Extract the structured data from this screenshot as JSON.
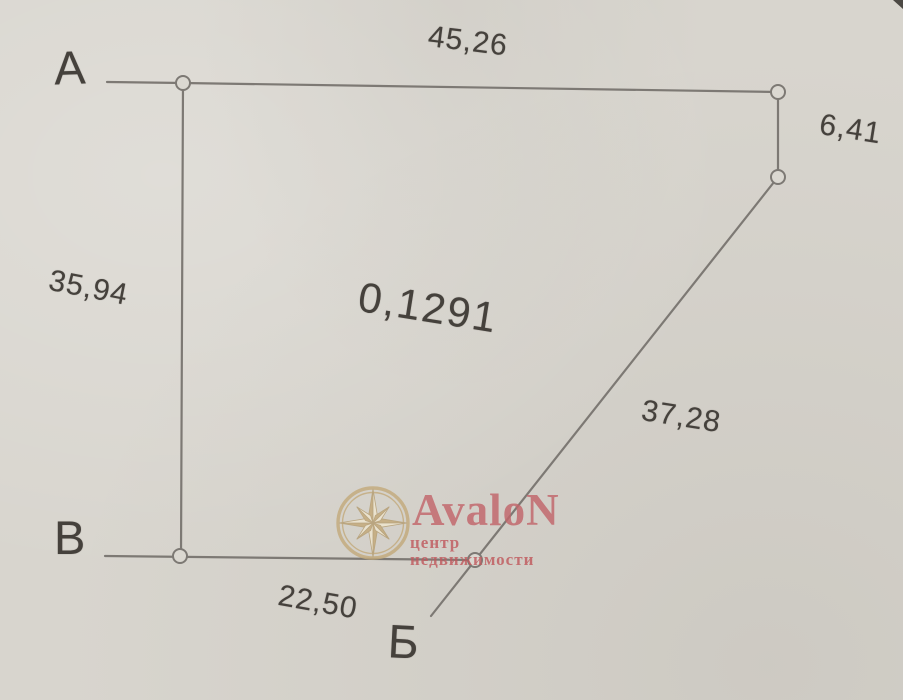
{
  "plan": {
    "area": "0,1291",
    "vertices": {
      "a": "А",
      "b": "Б",
      "v": "В"
    },
    "sides": {
      "top": "45,26",
      "right": "6,41",
      "left": "35,94",
      "diagonal": "37,28",
      "bottom": "22,50"
    }
  },
  "watermark": {
    "brand": "AvaloN",
    "tagline": "центр недвижимости",
    "logo": "compass-rose-icon",
    "brand_color": "#c2666b",
    "tagline_color": "#c05a5e",
    "logo_color": "#c3aa7c"
  },
  "colors": {
    "paper": "#d8d5ce",
    "line": "#7d7974",
    "ink": "#45413c"
  }
}
